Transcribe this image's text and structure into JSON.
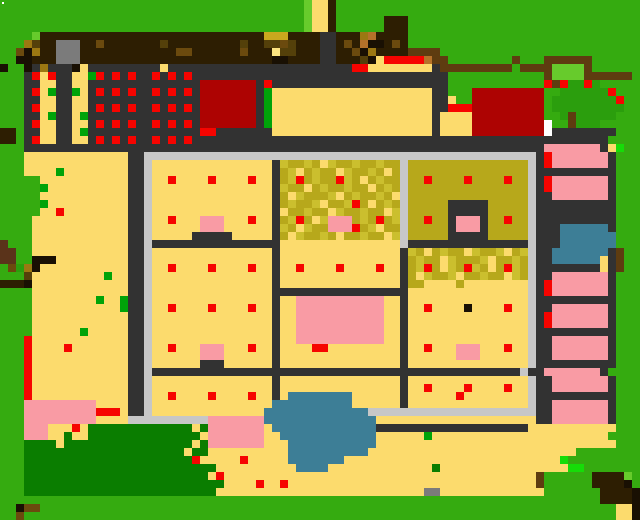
{
  "map": {
    "grid_width": 80,
    "grid_height": 65,
    "cell_size": 8,
    "palette": {
      ".": {
        "color": "#35ab10",
        "name": "grass"
      },
      ",": {
        "color": "#0a7d00",
        "name": "dark-lawn"
      },
      "T": {
        "color": "#2b9e0d",
        "name": "tree-foliage"
      },
      "g": {
        "color": "#67cb2c",
        "name": "light-green-accent"
      },
      "L": {
        "color": "#16dc08",
        "name": "lime-sprout"
      },
      "E": {
        "color": "#00a309",
        "name": "green-dot-item"
      },
      "Y": {
        "color": "#fcdb6d",
        "name": "sand-path"
      },
      "m": {
        "color": "#fce481",
        "name": "pale-sand"
      },
      "O": {
        "color": "#b7a81b",
        "name": "olive-field"
      },
      "o": {
        "color": "#cbbf2e",
        "name": "olive-field-light"
      },
      "M": {
        "color": "#c9a81e",
        "name": "mustard-patch"
      },
      "D": {
        "color": "#323232",
        "name": "dark-road"
      },
      "l": {
        "color": "#c7c7c7",
        "name": "plaza-wall"
      },
      "A": {
        "color": "#7b7b7b",
        "name": "stone-block"
      },
      "R": {
        "color": "#f60400",
        "name": "red-item"
      },
      "r": {
        "color": "#ad0302",
        "name": "red-building-roof"
      },
      "P": {
        "color": "#f99ba4",
        "name": "pink-patch"
      },
      "B": {
        "color": "#2d1e02",
        "name": "dark-brown-soil"
      },
      "k": {
        "color": "#191003",
        "name": "near-black-brown"
      },
      "b": {
        "color": "#5e3c10",
        "name": "fence-brown"
      },
      "u": {
        "color": "#5a331a",
        "name": "rust-brown"
      },
      "G": {
        "color": "#9c7812",
        "name": "gold-brown"
      },
      "d": {
        "color": "#54400a",
        "name": "dark-olive-brown"
      },
      "q": {
        "color": "#6b4a0e",
        "name": "mid-brown"
      },
      "t": {
        "color": "#b5722a",
        "name": "orange-brown"
      },
      "W": {
        "color": "#ffffff",
        "name": "white-marker"
      },
      "w": {
        "color": "#3d7e96",
        "name": "water"
      }
    },
    "white_dot": {
      "x": 2,
      "y": 2,
      "w": 2,
      "h": 2,
      "color": "#ffffff"
    },
    "rows": [
      "......................................gYYB......................................",
      "......................................gYYB......................................",
      "......................................gYYB......BBB.............................",
      "......................................gYYB......BBB.............................",
      "....gBBBBBBBBBBBBBBBBBBBBBBBBBBBBMMMBBBBDDBBBGtBBBB.............................",
      "...GdBBAAABBqBBBBBBBdBBBBBBBBBdBBddqdBBBDDBqBtkkBqB.............................",
      "..qkGBBAAABBBBBBBBBBBBqqBBBBBBqBBBmddBBBDDBBqkGBBBBbbbb.........................",
      "..kkBBBAAABBBBBBBBBBBBBBBBBBBBBBBBkkBBBBDDBBBdkYRRRRRtbb........b...bbbbbb......",
      "k..kDGDDDkYDDDDDDDDDYDDDDDDDDDDDDDDDDDDDDDDDRRYYYYYYYYDbbbbbbbbb.bbbbggggb......",
      "...DRYRDDYYERDRDRDDRDRDRDDDDDDDDDDDDDDDDDDDDDDDDDDDDDDDD............bggggbbbbbb.",
      "...DDYYDDYYDDDDDDDDDDDDDDrrrrrrrDRDDDDDDDDDDDDDDDDDDDDDD............RbRTTRT.....",
      "...DRYEDDEYDRDRDRDDRDRDRDrrrrrrrDEYYYYYYYYYYYYYYYYYYYYDD...rrrrrrrrr..TTTTTTR...",
      "...DDYYDDYYDDDDDDDDDDDDDDrrrrrrrDEYYYYYYYYYYYYYYYYYYYYDDY..rrrrrrrrr.TTTTTTTTR..",
      "...DRYYDDYYDRDRDRDDRDRDRDrrrrrrrDEYYYYYYYYYYYYYYYYYYYYDDRRRrrrrrrrrr.TTTTTTTTT..",
      "...DDYEDDYEDDDDDDDDDDDDDDrrrrrrrDEYYYYYYYYYYYYYYYYYYYYDYYYYrrrrrrrrr..TbTTTTT...",
      "...DRYYDDYYDRDRDRDDRDRDRDrrrrrrrDEYYYYYYYYYYYYYYYYYYYYDYYYYrrrrrrrrrW..bTTT.....",
      "BB.DDYYDDYEDDDDDDDDDDDDDDRRDDDDDDDYYYYYYYYYYYYYYYYYYYYDYYYYrrrrrrrrrWDDDDDDDD...",
      "BB.DRYYDDYYDRDRDRDDRDRDRDDDDDDDDDDDDDDDDDDDDDDDDDDDDDDDDDDDDDDDDDDDDDDDDDDDD...",
      "...DDDDDDDDDDDDDDDDDDDDDDDDDDDDDDDDDDDDDDDDDDDDDDDDDDDDDDDDDDDDDDDDDPPPPPPPDYL.",
      "...YYYYYYYYYYYYYDDlllllllllllllllllllllllllllllllllllllllllllllllllDRPPPPPPPD...",
      "...YYYYYYYYYYYYYDDlYYYYYYYYYYYYYYYDoOOoOYoOOoOOoOOlOOOOOOOOOOOOOOOlDRPPPPPPPD...",
      "...YYYYEYYYYYYYYDDlYYYYYYYYYYYYYYYDOoYOoOOYoOOoOYOlOOOOOOOOOOOOOOOlDDDDDDDDDD...",
      ".....YYYYYYYYYYYDDlYYRYYYYRYYYYRYYDOoROoOORoOYOoOOlOOROOOOROOOOROOlDRPPPPPPPD...",
      ".....EYYYYYYYYYYDDlYYYYYYYYYYYYYYYDoOOYOoOOoOOYOoOlOOOOOOOOOOOOOOOlDRPPPPPPPD...",
      ".....YYYYYYYYYYYDDlYYYYYYYYYYYYYYYDOYoOOOoYOoOOoOYlOOOOOOOOOOOOOOOlDDPPPPPPPD...",
      ".....EYYYYYYYYYYDDlYYYYYYYYYYYYYYYDOoOOoYOOoROYOoOlOOOOODDDDDOOOOOlDDDDDDDDDD...",
      ".....YYRYYYYYYYYDDlYYYYYYYYYYYYYYYDYOOoOOYoOOoOOYolOOOOODDDDDOOOOOlDDDDDDDDDD...",
      "....YYYYYYYYYYYYDDlYYRYYYPPPYYYRYYDOoROYoPPPOoOROolOOROODPPPDOOROOlDDDDDDDDDD...",
      "....YYYYYYYYYYYYDDlYYYYYYPPPYYYYYYDoOYoOOPPPROoYOOlOOOOODPPPDOOOOOlDDDwwwwwwD...",
      "....YYYYYYYYYYYYDDlYYYYYDDDDDYYYYYDOYoOOoOYOOoOOYolOOOOODDDDDOOOOOlDDDwwwwwww...",
      "u...YYYYYYYYYYYYDDlDDDDDDDDDDDDDDDDYYYYYYYYYYYYYYYlDDDDDDDDDDDDDDDlDDDwwwwwww...",
      "uu..YYYYYYYYYYYYDDlYYYYYYYYYYYYYYYDYYYYYYYYYYYYYYYDoOYOoOOYoOOoYOolDDwwwwwwwDb..",
      "uu..kkkYYYYYYYYYDDlYYYYYYYYYYYYYYYDYYYYYYYYYYYYYYYDOoOOYoOOOoYOOoOlDDwwwwwwYDb..",
      ".qTGkYYYYYYYYYYYDDlYYRYYYYRYYYYRYYDYYRYYYYRYYYYRYYDOoROYoORoOYORoOlDDDDDDDDYDb..",
      "...dYYYYYYYYYEYYDDlYYYYYYYYYYYYYYYDYYYYYYYYYYYYYYYDOYoOOoYOOoOOYoOlDDPPPPPPPD...",
      "BBBkYYYYYYYYYYYYDDlYYYYYYYYYYYYYYYDYYYYYYYYYYYYYYYDOOYYYYOYYYYYYYYlDRPPPPPPPD...",
      "....YYYYYYYYYYYYDDlYYYYYYYYYYYYYYYDDDDDDDDDDDDDDDDDYYYYYYYYYYYYYYYlDRPPPPPPPD...",
      "....YYYYYYYYEYYEDDlYYYYYYYYYYYYYYYDYYPPPPPPPPPPPYYDYYYYYYYYYYYYYYYlDDDDDDDDDD...",
      "....YYYYYYYYYYYEDDlYYRYYYYRYYYYRYYDYYPPPPPPPPPPPYYDYYRYYYYkYYYYRYYlDDPPPPPPPD...",
      "....YYYYYYYYYYYYDDlYYYYYYYYYYYYYYYDYYPPPPPPPPPPPYYDYYYYYYYYYYYYYYYlDRPPPPPPPD...",
      "....YYYYYYYYYYYYDDlYYYYYYYYYYYYYYYDYYPPPPPPPPPPPYYDYYYYYYYYYYYYYYYlDRPPPPPPPD...",
      "....YYYYYYEYYYYYDDlYYYYYYYYYYYYYYYDYYPPPPPPPPPPPYYDYYYYYYYYYYYYYYYlDDDDDDDDDD...",
      "...RYYYYYYYYYYYYDDlYYYYYYYYYYYYYYYDYYPPPPPPPPPPPYYDYYYYYYYYYYYYYYYlDDPPPPPPPD...",
      "...RYYYYRYYYYYYYDDlYYRYYYPPPYYYRYYDYYYYRRYYYYYYYYYDYYRYYYPPPYYYRYYlDDPPPPPPPD...",
      "...RYYYYYYYYYYYYDDlYYYYYYPPPYYYYYYDYYYYYYYYYYYYYYYDYYYYYYPPPYYYYYYlDDPPPPPPPD...",
      "...RYYYYYYYYYYYYDDlYYYYYYDDDYYYYYYDYYYYYYYYYYYYYYYDYYYYYYYYYYYYYYYlDDDDDDDDDD...",
      "...RYYYYYYYYYYYYDDlDDDDDDDDDDDDDDDDDDDDDDDDDDDDDDDDDDDDDDDDDDDDDDlDDPPPPPPPD...",
      "...RYYYYYYYYYYYYDDlYYYYYYYYYYYYYYYDYYYYYYYYYYYYYYYDYYYYYYYYYYYYYYYlDDPPPPPPPD...",
      "...RYYYYYYYYYYYYDDlYYYYYYYYYYYYYYYDYYYYYYYYYYYYYYYDYYRYYYYRYYYYRYYlDDPPPPPPPD...",
      "...RYYYYYYYYYYYYDDlYYRYYYYRYYYYRYYDYwwwwwwwwYYYYYYDYYYYYYRYYYYYYYYlDDDDDDDDDD...",
      "...PPPPPPPPPYYYYDDlYYYYYYYYYYYYYYYwwwwwwwwwwYYYYYYDYYYYYYYYYYYYYYYlDDPPPPPPPD...",
      "...PPPPPPPPPRRRYDDlYYYYYYYYYYYYYYwwwwwwwwwwwwwlllllllllllllllllllllDDPPPPPPPD...",
      "...PPPPPPPPPYYYYllllllllllPPPPPPPwwwwwwwwwwwwwwYYYYYYYYYYYYYYYYYYYYDDPPPPPPPD...",
      "...PPPYYYRY,,,,,,,,,,,,,Y,PPPPPPPYwwwwwwwwwwwwwDDDDDDDDDDDDDDDDDDDYYYYYYYYYYY...",
      "...PPPYY,YY,,,,,,,,,,,,,,YPPPPPPPYYwwwwwwwwwwwwYYYYYYEYYYYYYYYYYYYYYYYYYYYYY...",
      "...,,,,Y,,,,,,,,,,,,,,,,Y,PPPPPPPYYYwwwwwwwwwwwYYYYYYYYYYYYYYYYYYYYYYYYYYYYYY...",
      "...,,,,,,,,,,,,,,,,,,,,Y,,YYYYYYYYYYwwwwwwwwwwYYYYYYYYYYYYYYYYYYYYYYYYYY........",
      "...,,,,,,,,,,,,,,,,,,,,,RYYYYYRYYYYYwwwwwwwYYYYYYYYYYYYYYYYYYYYYYYYYYYL........",
      "...,,,,,,,,,,,,,,,,,,,,,,,,YYYYYYYYYYwwwwYYYYYYYYYYYYY,YYYYYYYYYYYYYYYYLL.......",
      "...,,,,,,,,,,,,,,,,,,,,,,,YRYYYYYYYYYYYYYYYYYYYYYYYYYYYYYYYYYYYYYYYb......BBBBg",
      "...,,,,,,,,,,,,,,,,,,,,,,,,,YYYYRYYRYYYYYYYYYYYYYYYYYYYYYYYYYYYYYYYb......BBBBk",
      "...,,,,,,,,,,,,,,,,,,,,,,,,YYYYYYYYYYYYYYYYYYYYYYYYYYAAYYYYYYYYYYYYY.......BBBBk",
      "...........................................................................BBBBk",
      "..kqq........................................................................YYk",
      "..q..........................................................................YYk"
    ],
    "features": [
      {
        "name": "market-stall-area",
        "cells": "cols 3-23, rows 8-18"
      },
      {
        "name": "red-building-west",
        "cells": "cols 25-31, rows 10-15"
      },
      {
        "name": "red-building-east",
        "cells": "cols 59-67, rows 11-16"
      },
      {
        "name": "walled-plaza",
        "cells": "cols 18-66, rows 19-52"
      },
      {
        "name": "pink-room-bars",
        "cells": "cols 69-75, rows 18-52"
      },
      {
        "name": "blue-pool",
        "cells": "cols 69-76, rows 28-33"
      },
      {
        "name": "pond",
        "cells": "cols 33-46, rows 49-58"
      },
      {
        "name": "dark-lawn",
        "cells": "cols 3-26, rows 53-61"
      },
      {
        "name": "farm-house",
        "cells": "cols 42-50, rows 2-7"
      },
      {
        "name": "tree-top-right",
        "cells": "cols 68-77, rows 10-15"
      }
    ]
  }
}
